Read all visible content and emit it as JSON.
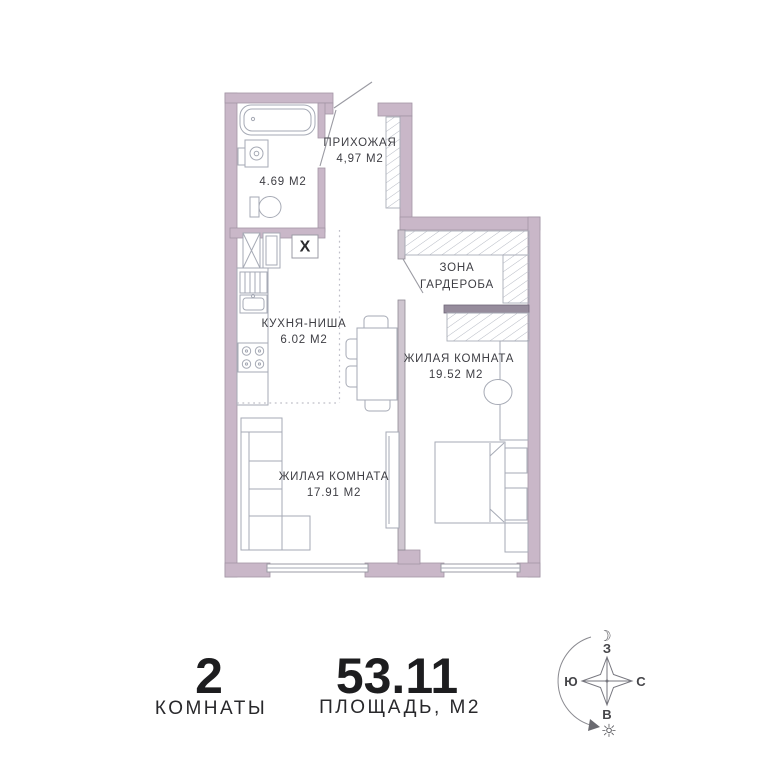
{
  "floorplan": {
    "rooms": {
      "hallway": {
        "label": "ПРИХОЖАЯ",
        "area": "4,97 М2"
      },
      "bathroom": {
        "area": "4.69 М2"
      },
      "wardrobe_zone": {
        "line1": "ЗОНА",
        "line2": "ГАРДЕРОБА"
      },
      "kitchen_niche": {
        "label": "КУХНЯ-НИША",
        "area": "6.02 М2"
      },
      "living_room_right": {
        "label": "ЖИЛАЯ КОМНАТА",
        "area": "19.52 М2"
      },
      "living_room_left": {
        "label": "ЖИЛАЯ КОМНАТА",
        "area": "17.91 М2"
      }
    },
    "shaft_label": "X"
  },
  "summary": {
    "rooms_value": "2",
    "rooms_label": "КОМНАТЫ",
    "area_value": "53.11",
    "area_label": "ПЛОЩАДЬ, М2"
  },
  "compass": {
    "top": "З",
    "left": "Ю",
    "right": "С",
    "bottom": "В",
    "moon": "☽",
    "sun": "☼"
  },
  "colors": {
    "wall": "#c9b7c8",
    "wall_dark": "#968c9c",
    "furniture_line": "#a6aab5",
    "text": "#3e3e44"
  }
}
